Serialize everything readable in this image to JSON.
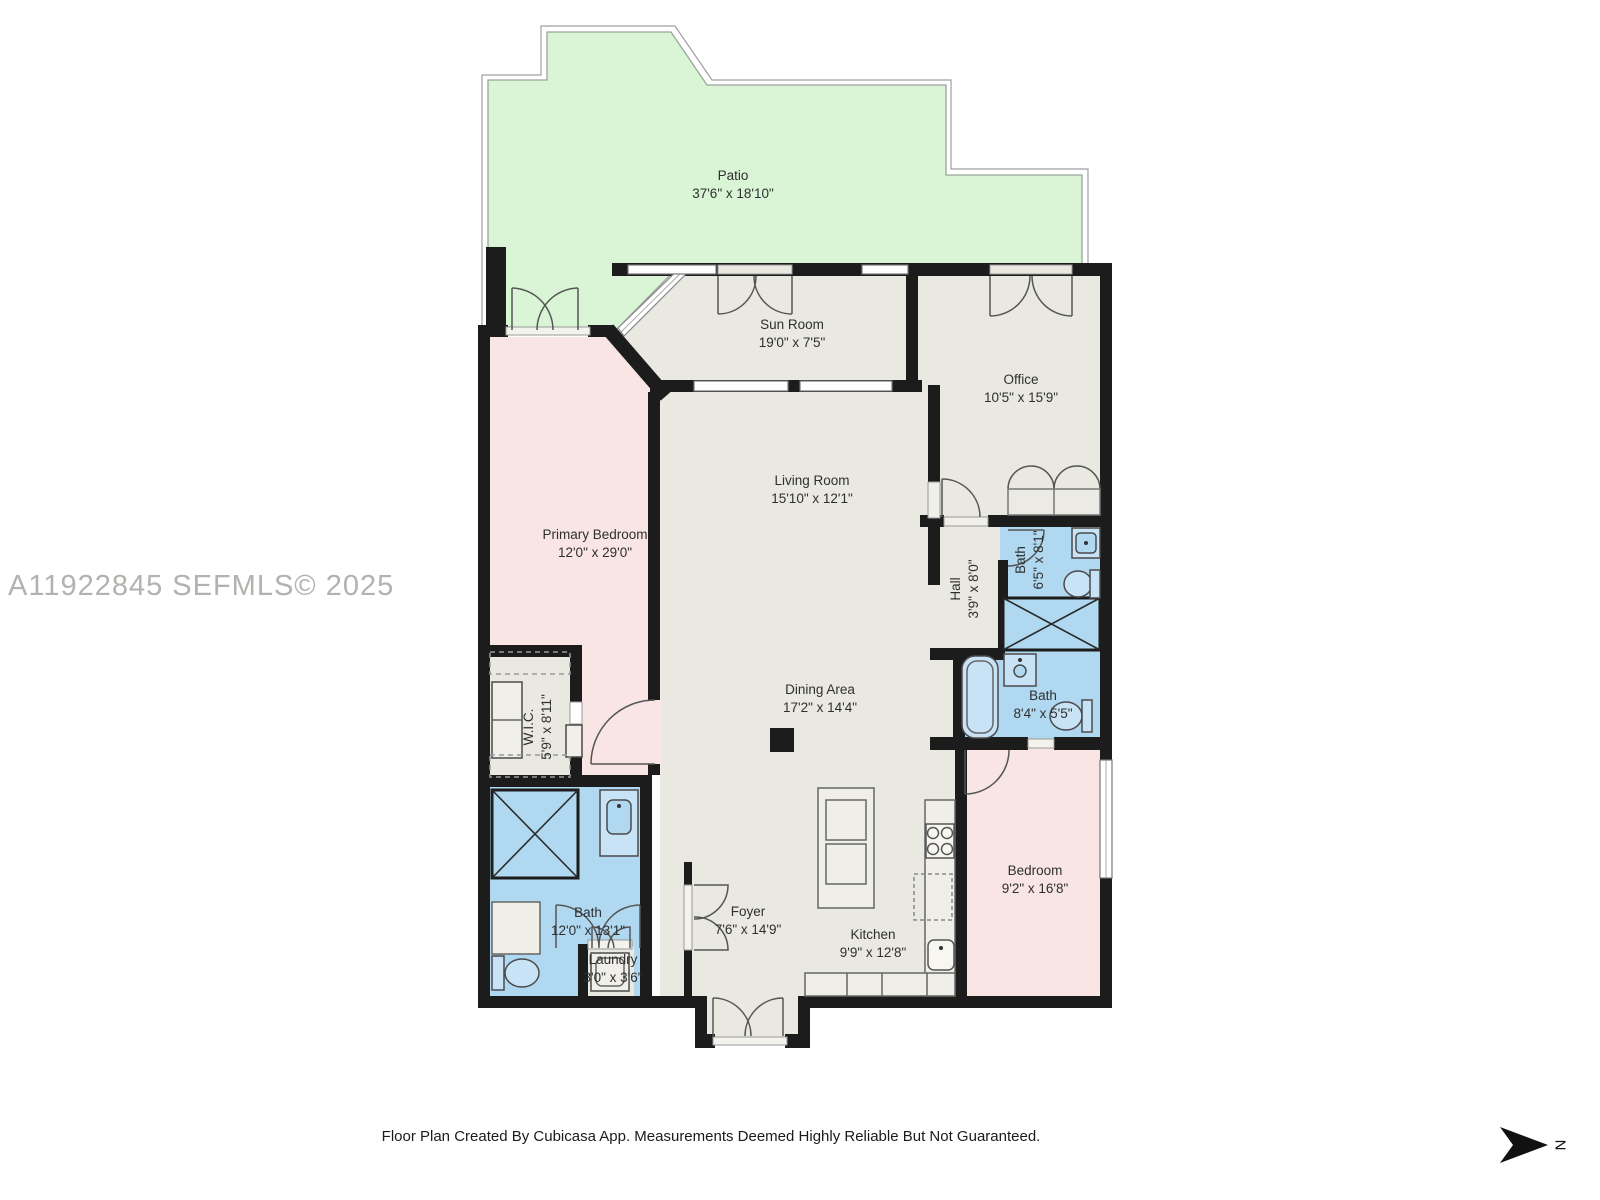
{
  "watermark": "A11922845  SEFMLS© 2025",
  "footer": "Floor Plan Created By Cubicasa App. Measurements Deemed Highly Reliable But Not Guaranteed.",
  "compass": {
    "label": "N"
  },
  "colors": {
    "patio_green": "#d9f5d5",
    "room_gray": "#e9e8e1",
    "bedroom_pink": "#f8e5e4",
    "bath_blue": "#b0d8f0",
    "wall_black": "#1c1c1c"
  },
  "rooms": [
    {
      "name": "Patio",
      "dims": "37'6\" x 18'10\""
    },
    {
      "name": "Sun Room",
      "dims": "19'0\" x 7'5\""
    },
    {
      "name": "Office",
      "dims": "10'5\" x 15'9\""
    },
    {
      "name": "Living Room",
      "dims": "15'10\" x 12'1\""
    },
    {
      "name": "Primary Bedroom",
      "dims": "12'0\" x 29'0\""
    },
    {
      "name": "Hall",
      "dims": "3'9\" x 8'0\""
    },
    {
      "name": "Bath",
      "dims": "6'5\" x 8'1\""
    },
    {
      "name": "Dining Area",
      "dims": "17'2\" x 14'4\""
    },
    {
      "name": "Bath",
      "dims": "8'4\" x 5'5\""
    },
    {
      "name": "W.I.C.",
      "dims": "5'9\" x 8'11\""
    },
    {
      "name": "Bath",
      "dims": "12'0\" x 13'1\""
    },
    {
      "name": "Laundry",
      "dims": "3'0\" x 3'6\""
    },
    {
      "name": "Foyer",
      "dims": "7'6\" x 14'9\""
    },
    {
      "name": "Kitchen",
      "dims": "9'9\" x 12'8\""
    },
    {
      "name": "Bedroom",
      "dims": "9'2\" x 16'8\""
    }
  ]
}
